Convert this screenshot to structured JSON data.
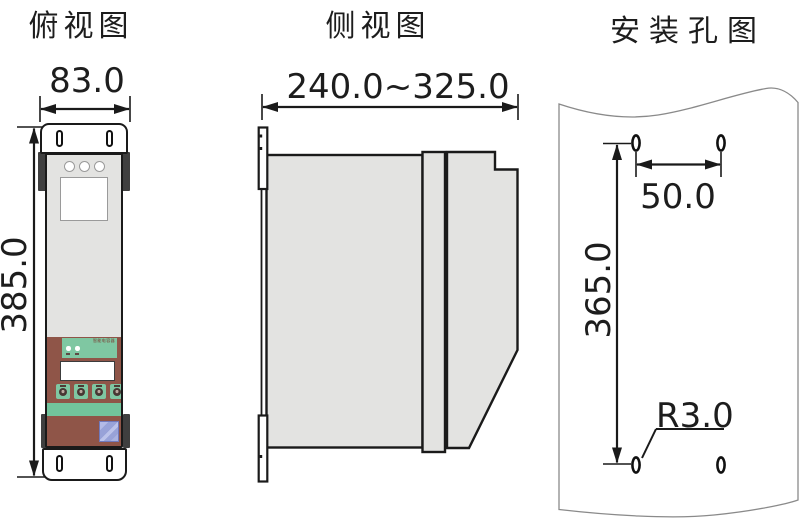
{
  "drawing_title": "capacitor-three-view-drawing",
  "colors": {
    "line": "#1a1a1a",
    "body_gray": "#e3e3e1",
    "flange_dark": "#3f3f3f",
    "panel_brown": "#8f5548",
    "panel_green": "#7fc7a2",
    "strip_green": "#72c49c",
    "label_blue": "#98a2d8",
    "panel_outline_gray": "#8a8a8a",
    "background": "#ffffff"
  },
  "views": {
    "top": {
      "title": "俯视图",
      "dimensions": {
        "width": "83.0",
        "height": "385.0"
      },
      "device": {
        "panel_text": "智能电容器"
      }
    },
    "side": {
      "title": "侧视图",
      "dimensions": {
        "depth_range": "240.0~325.0"
      }
    },
    "mounting": {
      "title": "安装孔图",
      "dimensions": {
        "hole_spacing_horizontal": "50.0",
        "hole_spacing_vertical": "365.0",
        "hole_radius": "R3.0"
      }
    }
  }
}
